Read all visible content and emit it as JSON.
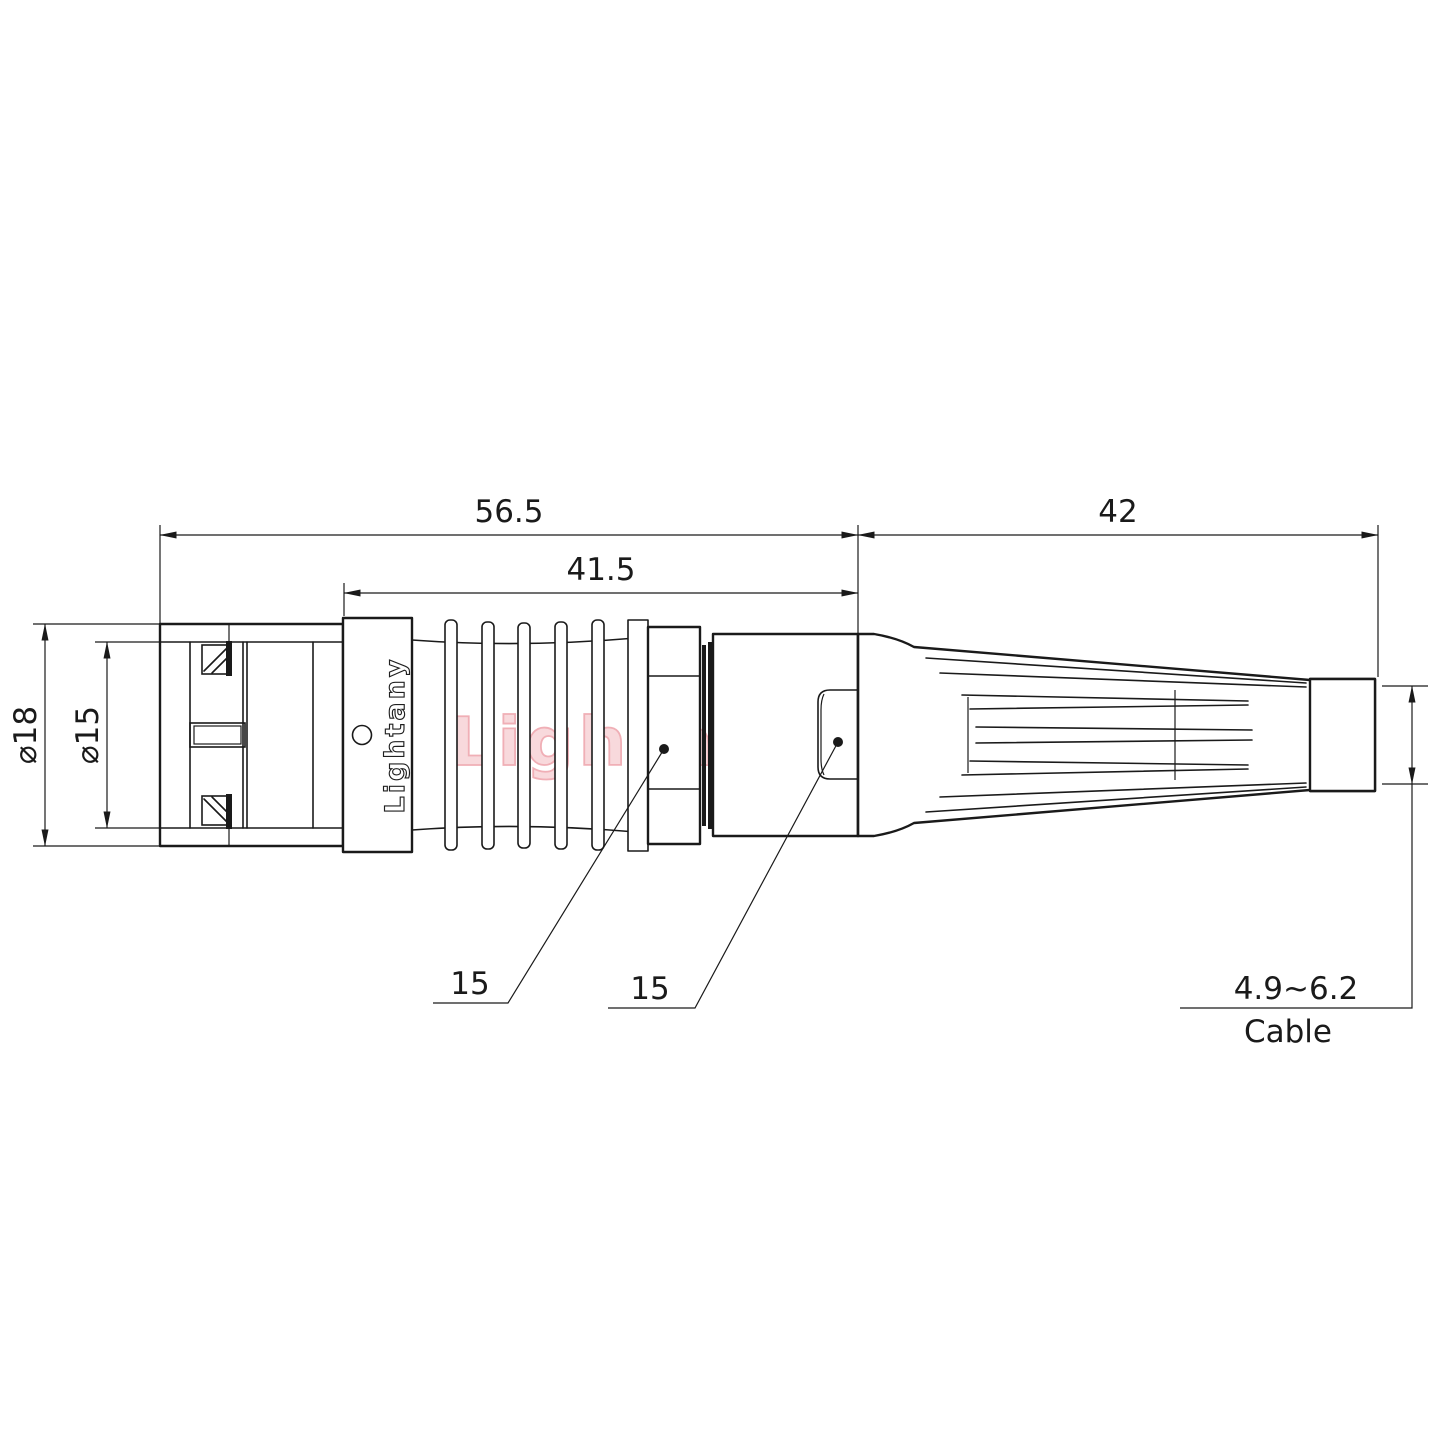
{
  "drawing": {
    "brand": "Lightany",
    "watermark": "Lightany",
    "line_color": "#1a1a1a",
    "watermark_color": "#eea2aa",
    "dimensions": {
      "total_length": "56.5",
      "body_length": "41.5",
      "boot_length": "42",
      "outer_diameter": "⌀18",
      "inner_diameter": "⌀15"
    },
    "callouts": {
      "left": "15",
      "right": "15"
    },
    "cable": {
      "range": "4.9~6.2",
      "label": "Cable"
    }
  }
}
